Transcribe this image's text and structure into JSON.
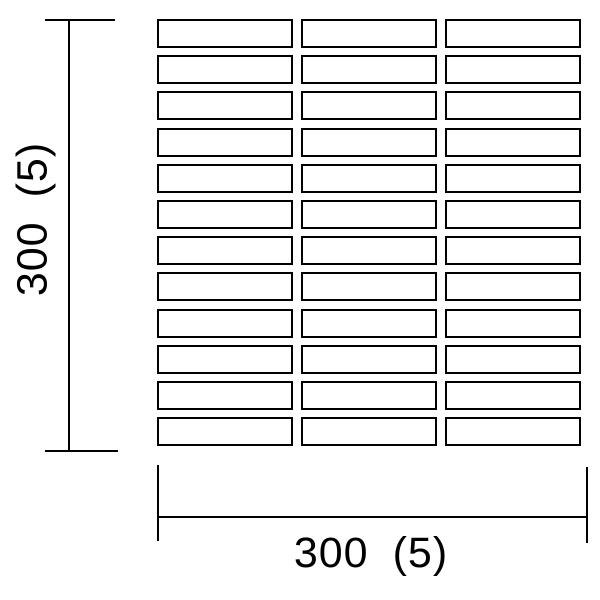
{
  "drawing": {
    "grid": {
      "rows": 12,
      "columns": 3,
      "tile_width_px": 136,
      "tile_height_px": 29
    },
    "dimension_vertical": {
      "value": "300",
      "joint": "(5)",
      "full_label": "300 (5)"
    },
    "dimension_horizontal": {
      "value": "300",
      "joint": "(5)",
      "full_label": "300 (5)"
    },
    "colors": {
      "background": "#ffffff",
      "line": "#000000"
    }
  }
}
